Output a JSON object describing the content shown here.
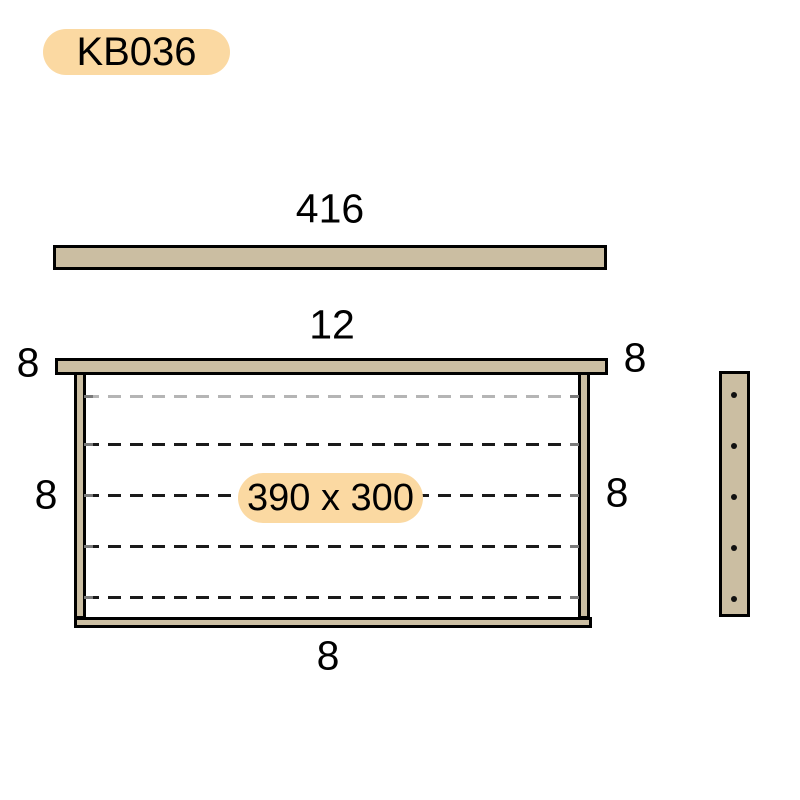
{
  "part_badge": {
    "label": "KB036"
  },
  "colors": {
    "wood_fill": "#CBBEA2",
    "outline": "#000000",
    "badge_fill": "#FBD9A2",
    "wire_light": "#B5B5B5",
    "wire_dark": "#1A1A1A",
    "tick": "#7A7A7A",
    "background": "#FFFFFF"
  },
  "top_bar_view": {
    "dim_length": "416"
  },
  "front_view": {
    "dim_top_thickness": "12",
    "dim_lug_left": "8",
    "dim_lug_right": "8",
    "dim_side_left": "8",
    "dim_side_right": "8",
    "dim_bottom": "8",
    "dim_opening": "390 x 300",
    "wire_count": 5
  },
  "side_view": {
    "hole_count": 5
  }
}
